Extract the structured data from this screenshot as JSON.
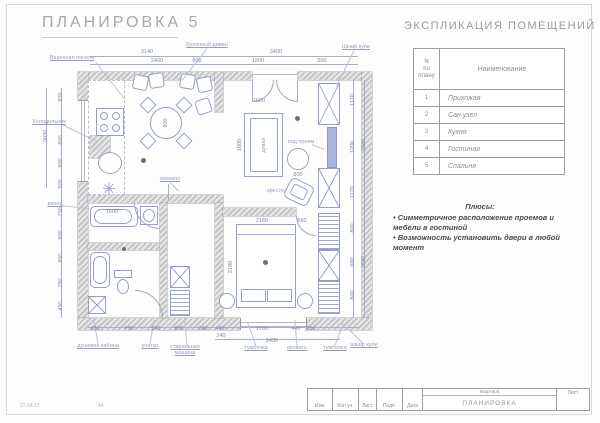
{
  "page": {
    "title": "ПЛАНИРОВКА 5",
    "footer_date": "27.04.17",
    "footer_num": "44"
  },
  "explication": {
    "title": "ЭКСПЛИКАЦИЯ ПОМЕЩЕНИЙ",
    "col_num": "N\nпо\nплану",
    "col_name": "Наименование",
    "rows": [
      {
        "num": "1",
        "name": "Прихожая"
      },
      {
        "num": "2",
        "name": "Сан узел"
      },
      {
        "num": "3",
        "name": "Кухня"
      },
      {
        "num": "4",
        "name": "Гостиная"
      },
      {
        "num": "5",
        "name": "Спальня"
      }
    ]
  },
  "notes": {
    "heading": "Плюсы:",
    "items": [
      "• Симметричное расположение проемов и мебели в гостиной",
      "• Возможность установить двери в любой момент"
    ]
  },
  "stamp": {
    "cols": [
      "Изм.",
      "Кол.уч.",
      "Лист",
      "Подп.",
      "Дата"
    ],
    "project": "Квартира",
    "doc": "ПЛАНИРОВКА",
    "sheet": "Лист"
  },
  "plan": {
    "dims": [
      {
        "t": "3140",
        "x": 147,
        "y": 52
      },
      {
        "t": "3400",
        "x": 276,
        "y": 52
      },
      {
        "t": "2400",
        "x": 157,
        "y": 61
      },
      {
        "t": "800",
        "x": 197,
        "y": 61
      },
      {
        "t": "1200",
        "x": 258,
        "y": 61
      },
      {
        "t": "500",
        "x": 322,
        "y": 61
      },
      {
        "t": "3030",
        "x": 46,
        "y": 136,
        "r": -90
      },
      {
        "t": "830",
        "x": 61,
        "y": 97,
        "r": -90
      },
      {
        "t": "800",
        "x": 61,
        "y": 140,
        "r": -90
      },
      {
        "t": "800",
        "x": 61,
        "y": 163,
        "r": -90
      },
      {
        "t": "500",
        "x": 61,
        "y": 184,
        "r": -90
      },
      {
        "t": "750",
        "x": 61,
        "y": 212,
        "r": -90
      },
      {
        "t": "800",
        "x": 61,
        "y": 235,
        "r": -90
      },
      {
        "t": "800",
        "x": 61,
        "y": 258,
        "r": -90
      },
      {
        "t": "750",
        "x": 61,
        "y": 283,
        "r": -90
      },
      {
        "t": "450",
        "x": 61,
        "y": 306,
        "r": -90
      },
      {
        "t": "1170",
        "x": 353,
        "y": 100,
        "r": -90
      },
      {
        "t": "1200",
        "x": 353,
        "y": 147,
        "r": -90
      },
      {
        "t": "1170",
        "x": 353,
        "y": 192,
        "r": -90
      },
      {
        "t": "800",
        "x": 353,
        "y": 228,
        "r": -90
      },
      {
        "t": "600",
        "x": 353,
        "y": 262,
        "r": -90
      },
      {
        "t": "800",
        "x": 353,
        "y": 295,
        "r": -90
      },
      {
        "t": "3040",
        "x": 364,
        "y": 145,
        "r": -90
      },
      {
        "t": "2840",
        "x": 364,
        "y": 262,
        "r": -90
      },
      {
        "t": "430",
        "x": 95,
        "y": 329
      },
      {
        "t": "750",
        "x": 129,
        "y": 329
      },
      {
        "t": "540",
        "x": 156,
        "y": 329
      },
      {
        "t": "800",
        "x": 179,
        "y": 329
      },
      {
        "t": "240",
        "x": 203,
        "y": 329
      },
      {
        "t": "440",
        "x": 220,
        "y": 329
      },
      {
        "t": "1700",
        "x": 262,
        "y": 329
      },
      {
        "t": "440",
        "x": 296,
        "y": 329
      },
      {
        "t": "200",
        "x": 311,
        "y": 329
      },
      {
        "t": "240",
        "x": 221,
        "y": 336
      },
      {
        "t": "2430",
        "x": 272,
        "y": 341
      },
      {
        "t": "1600",
        "x": 112,
        "y": 212
      },
      {
        "t": "800",
        "x": 298,
        "y": 175
      },
      {
        "t": "1800",
        "x": 240,
        "y": 145,
        "r": -90
      },
      {
        "t": "1600",
        "x": 259,
        "y": 101
      },
      {
        "t": "800",
        "x": 166,
        "y": 123,
        "r": -90
      },
      {
        "t": "2160",
        "x": 262,
        "y": 221
      },
      {
        "t": "560",
        "x": 302,
        "y": 221
      },
      {
        "t": "2190",
        "x": 231,
        "y": 267,
        "r": -90
      }
    ],
    "labels": [
      {
        "t": "Варочная панель",
        "x": 72,
        "y": 58,
        "u": 1
      },
      {
        "t": "Кухонный диван",
        "x": 207,
        "y": 45,
        "u": 1
      },
      {
        "t": "Шкаф купе",
        "x": 356,
        "y": 47,
        "u": 1,
        "w": 34
      },
      {
        "t": "под проем",
        "x": 301,
        "y": 142
      },
      {
        "t": "диван",
        "x": 264,
        "y": 145,
        "r": -90
      },
      {
        "t": "кресло",
        "x": 276,
        "y": 191
      },
      {
        "t": "зеркало",
        "x": 170,
        "y": 179,
        "u": 1
      },
      {
        "t": "Холодильник",
        "x": 49,
        "y": 122,
        "u": 1,
        "w": 38
      },
      {
        "t": "ванна",
        "x": 55,
        "y": 204,
        "u": 1
      },
      {
        "t": "душевая кабина",
        "x": 98,
        "y": 346,
        "u": 1
      },
      {
        "t": "унитаз",
        "x": 150,
        "y": 346,
        "u": 1
      },
      {
        "t": "стиральная машина",
        "x": 185,
        "y": 350,
        "u": 1,
        "w": 50
      },
      {
        "t": "тумбочка",
        "x": 256,
        "y": 348,
        "u": 1
      },
      {
        "t": "кровать",
        "x": 297,
        "y": 348,
        "u": 1
      },
      {
        "t": "тумбочка",
        "x": 335,
        "y": 348,
        "u": 1
      },
      {
        "t": "шкаф купе",
        "x": 364,
        "y": 345,
        "u": 1,
        "w": 34
      }
    ]
  }
}
